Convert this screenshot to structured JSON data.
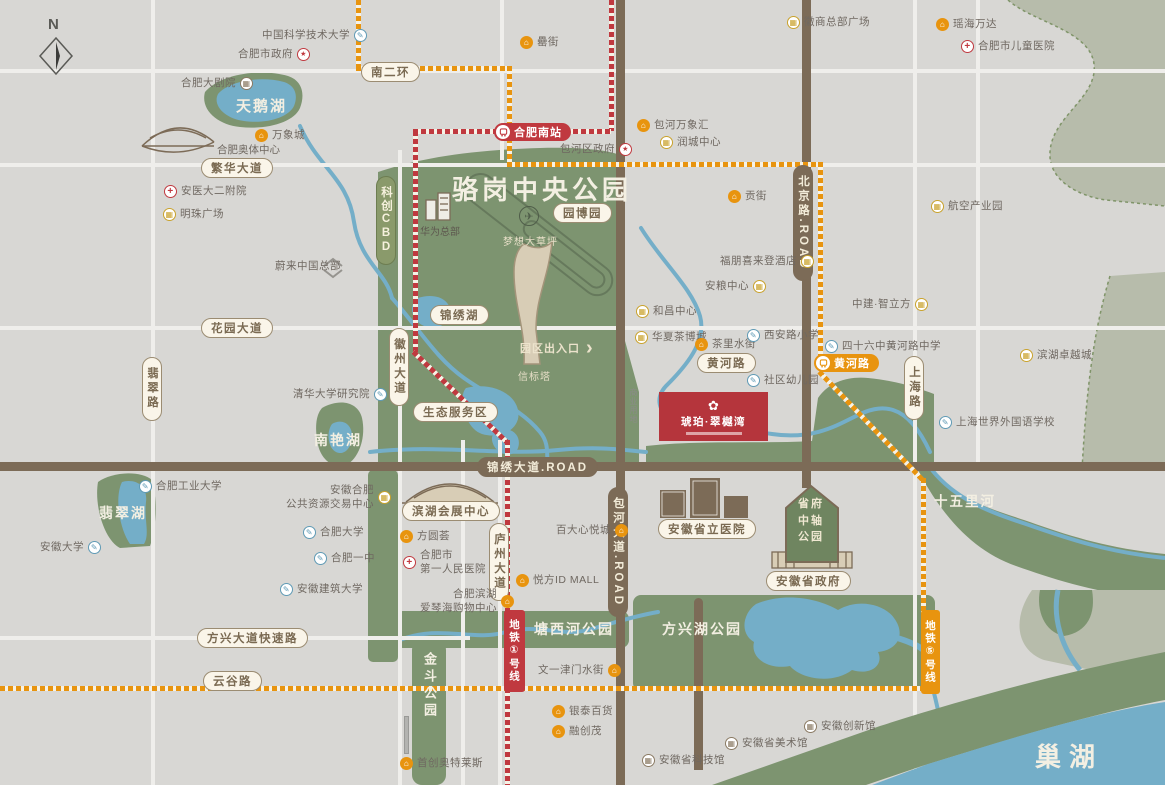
{
  "compass": {
    "label": "N"
  },
  "project": {
    "name": "琥珀·翠樾湾",
    "logo": "✿"
  },
  "colors": {
    "metro_line1": "#c0393f",
    "metro_line5": "#e8940f",
    "park_green": "#7d9470",
    "water_blue": "#74aec8",
    "road_brown": "#7c6b57",
    "project_red": "#b5353c"
  },
  "icon_glyphs": {
    "school": "✎",
    "enterprise": "▦",
    "museum": "▦",
    "gov": "★",
    "hospital": "+",
    "commerce": "⌂",
    "plane": "✈",
    "nio": "∧",
    "chevron": "›"
  },
  "roads": {
    "nanerhuan": "南二环",
    "fanhua": "繁华大道",
    "huayuan": "花园大道",
    "feicui": "翡翠路",
    "huizhou": "徽州大道",
    "luzhou": "庐州大道",
    "shanghai": "上海路",
    "fangxing": "方兴大道快速路",
    "yungu": "云谷路",
    "huanghe": "黄河路",
    "jinxiu": "锦绣大道.ROAD",
    "beijing": "北京路.ROAD",
    "baohe": "包河大道.ROAD",
    "kechuang_cbd": "科创CBD"
  },
  "metro": {
    "station_south": "合肥南站",
    "station_huanghe": "黄河路",
    "line1": "地铁①号线",
    "line5": "地铁⑤号线"
  },
  "areas": {
    "central_park": "骆岗中央公园",
    "expo_garden": "园博园",
    "dream_lawn": "梦想大草坪",
    "beacon_tower": "信标塔",
    "jinxiu_lake": "锦绣湖",
    "eco_zone": "生态服务区",
    "park_gate": "园区出入口",
    "swan_lake": "天鹅湖",
    "nanyan_lake": "南艳湖",
    "feicui_lake": "翡翠湖",
    "jindou_park": "金斗公园",
    "tangxihe_park": "塘西河公园",
    "fangxinghu_park": "方兴湖公园",
    "axis_park": "省府中轴公园",
    "shiwuli_river": "十五里河",
    "chaohu_lake": "巢湖",
    "commercial_land": "商业用地"
  },
  "landmarks": {
    "aoti": "合肥奥体中心",
    "huawei": "华为总部",
    "expo_center": "滨湖会展中心",
    "provincial_hospital": "安徽省立医院",
    "gov": "安徽省政府"
  },
  "pois": [
    {
      "label": "中国科学技术大学",
      "type": "school"
    },
    {
      "label": "合肥市政府",
      "type": "gov"
    },
    {
      "label": "合肥大剧院",
      "type": "museum"
    },
    {
      "label": "瑶海万达",
      "type": "commerce"
    },
    {
      "label": "合肥市儿童医院",
      "type": "hospital"
    },
    {
      "label": "罍街",
      "type": "commerce"
    },
    {
      "label": "包河万象汇",
      "type": "commerce"
    },
    {
      "label": "润城中心",
      "type": "enterprise"
    },
    {
      "label": "包河区政府",
      "type": "gov"
    },
    {
      "label": "万象城",
      "type": "commerce"
    },
    {
      "label": "贡街",
      "type": "commerce"
    },
    {
      "label": "航空产业园",
      "type": "enterprise"
    },
    {
      "label": "徽商总部广场",
      "type": "enterprise"
    },
    {
      "label": "安医大二附院",
      "type": "hospital"
    },
    {
      "label": "明珠广场",
      "type": "enterprise"
    },
    {
      "label": "蔚来中国总部",
      "type": "nio"
    },
    {
      "label": "清华大学研究院",
      "type": "school"
    },
    {
      "label": "福朋喜来登酒店",
      "type": "enterprise"
    },
    {
      "label": "安粮中心",
      "type": "enterprise"
    },
    {
      "label": "和昌中心",
      "type": "enterprise"
    },
    {
      "label": "华夏茶博城",
      "type": "enterprise"
    },
    {
      "label": "茶里水街",
      "type": "commerce"
    },
    {
      "label": "西安路小学",
      "type": "school"
    },
    {
      "label": "四十六中黄河路中学",
      "type": "school"
    },
    {
      "label": "中建·智立方",
      "type": "enterprise"
    },
    {
      "label": "社区幼儿园",
      "type": "school"
    },
    {
      "label": "滨湖卓越城",
      "type": "enterprise"
    },
    {
      "label": "上海世界外国语学校",
      "type": "school"
    },
    {
      "label": "合肥工业大学",
      "type": "school"
    },
    {
      "label": "安徽大学",
      "type": "school"
    },
    {
      "label": "安徽合肥\n公共资源交易中心",
      "type": "enterprise"
    },
    {
      "label": "合肥大学",
      "type": "school"
    },
    {
      "label": "合肥一中",
      "type": "school"
    },
    {
      "label": "安徽建筑大学",
      "type": "school"
    },
    {
      "label": "方圆荟",
      "type": "commerce"
    },
    {
      "label": "合肥市\n第一人民医院",
      "type": "hospital"
    },
    {
      "label": "合肥滨湖\n爱琴海购物中心",
      "type": "commerce"
    },
    {
      "label": "百大心悦城",
      "type": "commerce"
    },
    {
      "label": "悦方ID MALL",
      "type": "commerce"
    },
    {
      "label": "文一津门水街",
      "type": "commerce"
    },
    {
      "label": "银泰百货",
      "type": "commerce"
    },
    {
      "label": "融创茂",
      "type": "commerce"
    },
    {
      "label": "首创奥特莱斯",
      "type": "commerce"
    },
    {
      "label": "安徽省科技馆",
      "type": "museum"
    },
    {
      "label": "安徽省美术馆",
      "type": "museum"
    },
    {
      "label": "安徽创新馆",
      "type": "museum"
    }
  ]
}
